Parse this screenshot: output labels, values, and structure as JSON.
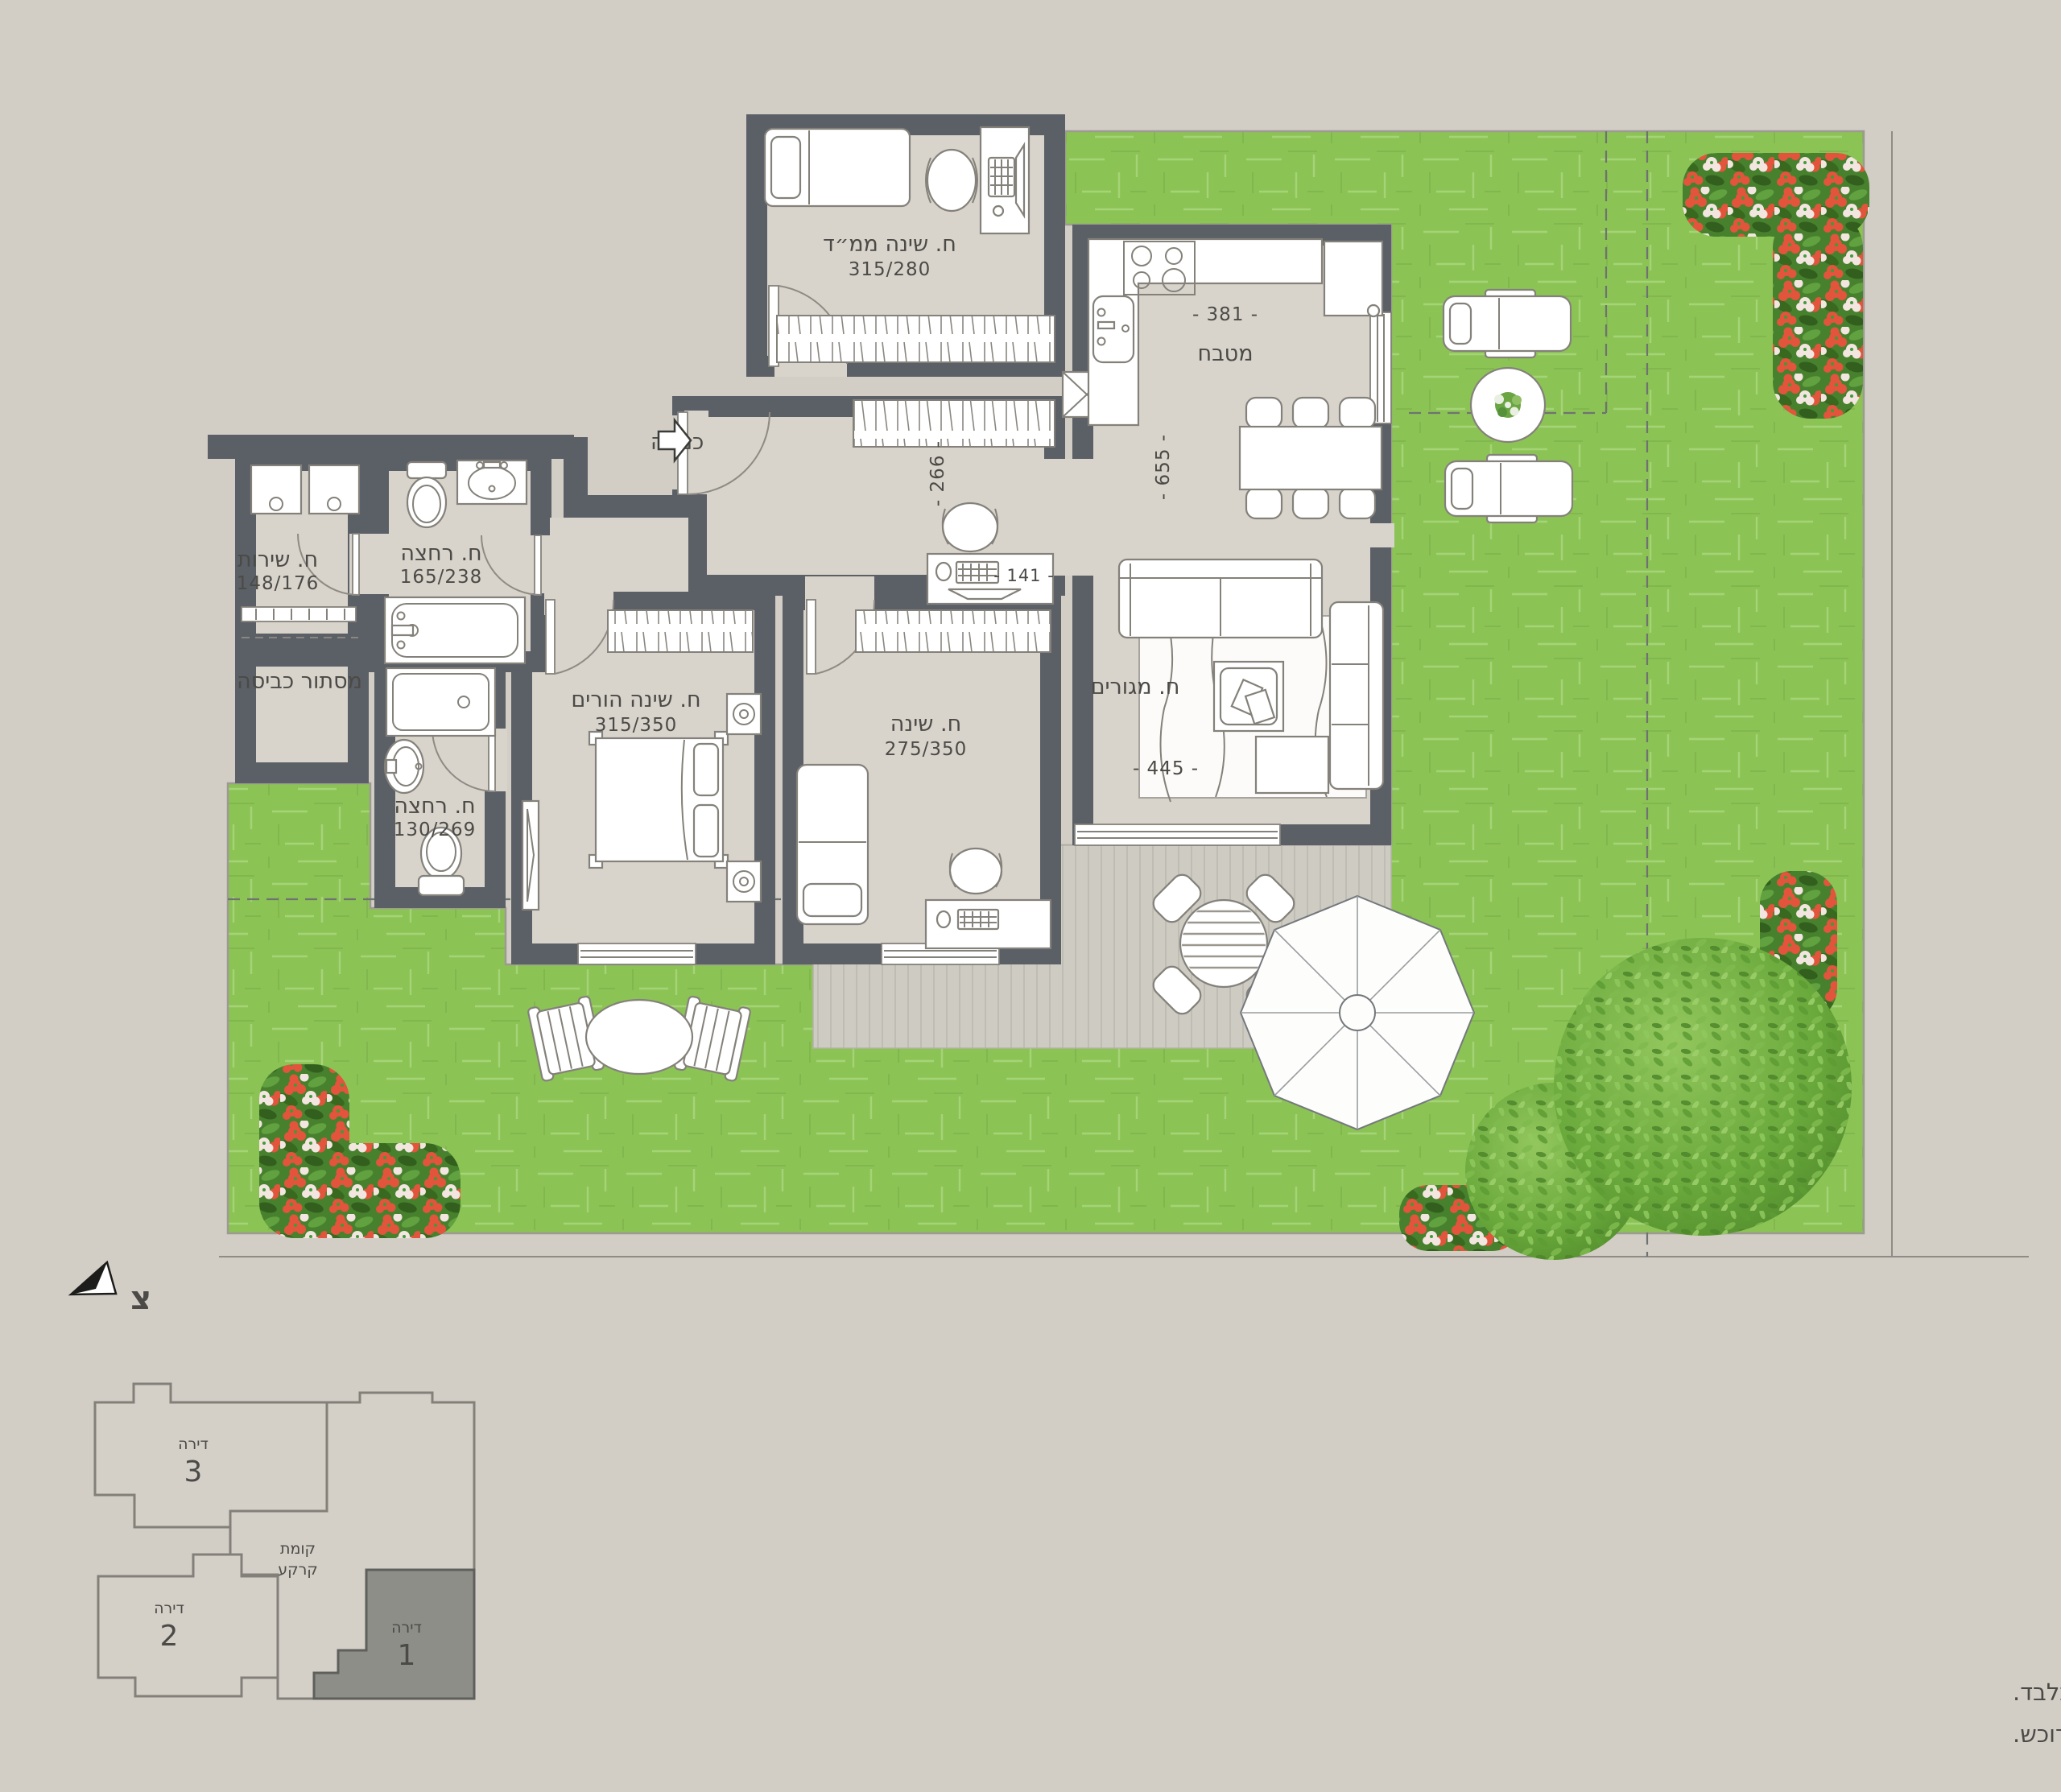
{
  "colors": {
    "background": "#d2cec6",
    "wall": "#5b5f66",
    "floor": "#d8d4cc",
    "lawn": "#8cc355",
    "deck": "#cecbc3",
    "flower_red": "#e0503a",
    "flower_white": "#f3e6e0",
    "bush_green": "#69a83e",
    "highlight_apartment": "#8e8e89"
  },
  "plan": {
    "entrance_label": "כניסה",
    "north_label": "צ",
    "rooms": {
      "mamad": {
        "name": "ח. שינה ממ״ד",
        "dims": "315/280"
      },
      "kitchen": {
        "name": "מטבח",
        "width_dim": "- 381 -",
        "depth_dim": "- 655 -"
      },
      "hall": {
        "width_dim": "- 266 -"
      },
      "living": {
        "name": "ח. מגורים",
        "width_dim": "- 445 -",
        "nook_dim": "- 141 -"
      },
      "master": {
        "name": "ח. שינה הורים",
        "dims": "315/350"
      },
      "bedroom": {
        "name": "ח. שינה",
        "dims": "275/350"
      },
      "service": {
        "name": "ח. שירות",
        "dims": "148/176"
      },
      "bath": {
        "name": "ח. רחצה",
        "dims": "165/238"
      },
      "bath2": {
        "name": "ח. רחצה",
        "dims": "130/269"
      },
      "laundry": {
        "name": "מסתור כביסה"
      }
    }
  },
  "key_plan": {
    "floor_label_line1": "קומת",
    "floor_label_line2": "קרקע",
    "apartments": [
      {
        "label": "דירה",
        "number": "3",
        "highlighted": false
      },
      {
        "label": "דירה",
        "number": "2",
        "highlighted": false
      },
      {
        "label": "דירה",
        "number": "1",
        "highlighted": true
      }
    ]
  },
  "disclaimer": {
    "line1": "*המידע במסמך זה ובהדמיות הינו כללי ונועד להמחשה ולהתרשמות בלבד.",
    "line2": "המסמכים המחייבים את החברה הינם הסכם המכר ונספחיו כשהם חתומים ע״י החברה והרוכש."
  }
}
